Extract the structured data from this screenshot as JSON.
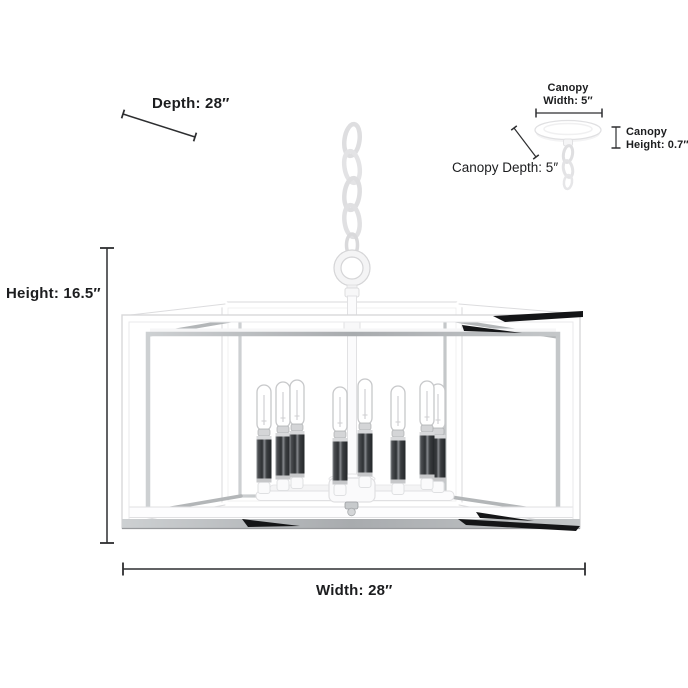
{
  "dimensions": {
    "depth": "Depth: 28″",
    "height": "Height: 16.5″",
    "width": "Width: 28″",
    "canopy_width": {
      "line1": "Canopy",
      "line2": "Width: 5″"
    },
    "canopy_height": {
      "line1": "Canopy",
      "line2": "Height: 0.7″"
    },
    "canopy_depth": "Canopy Depth: 5″"
  },
  "fixture": {
    "bulb_count": 8,
    "colors": {
      "background": "#ffffff",
      "frame_white": "#ffffff",
      "frame_edge": "#d9d9db",
      "chrome": "#b0b3b6",
      "chrome_reflection_dark": "#141517",
      "candle_sleeve": "#2e3134",
      "dimension_line": "#2d2e30",
      "text": "#1c1d1f"
    }
  }
}
